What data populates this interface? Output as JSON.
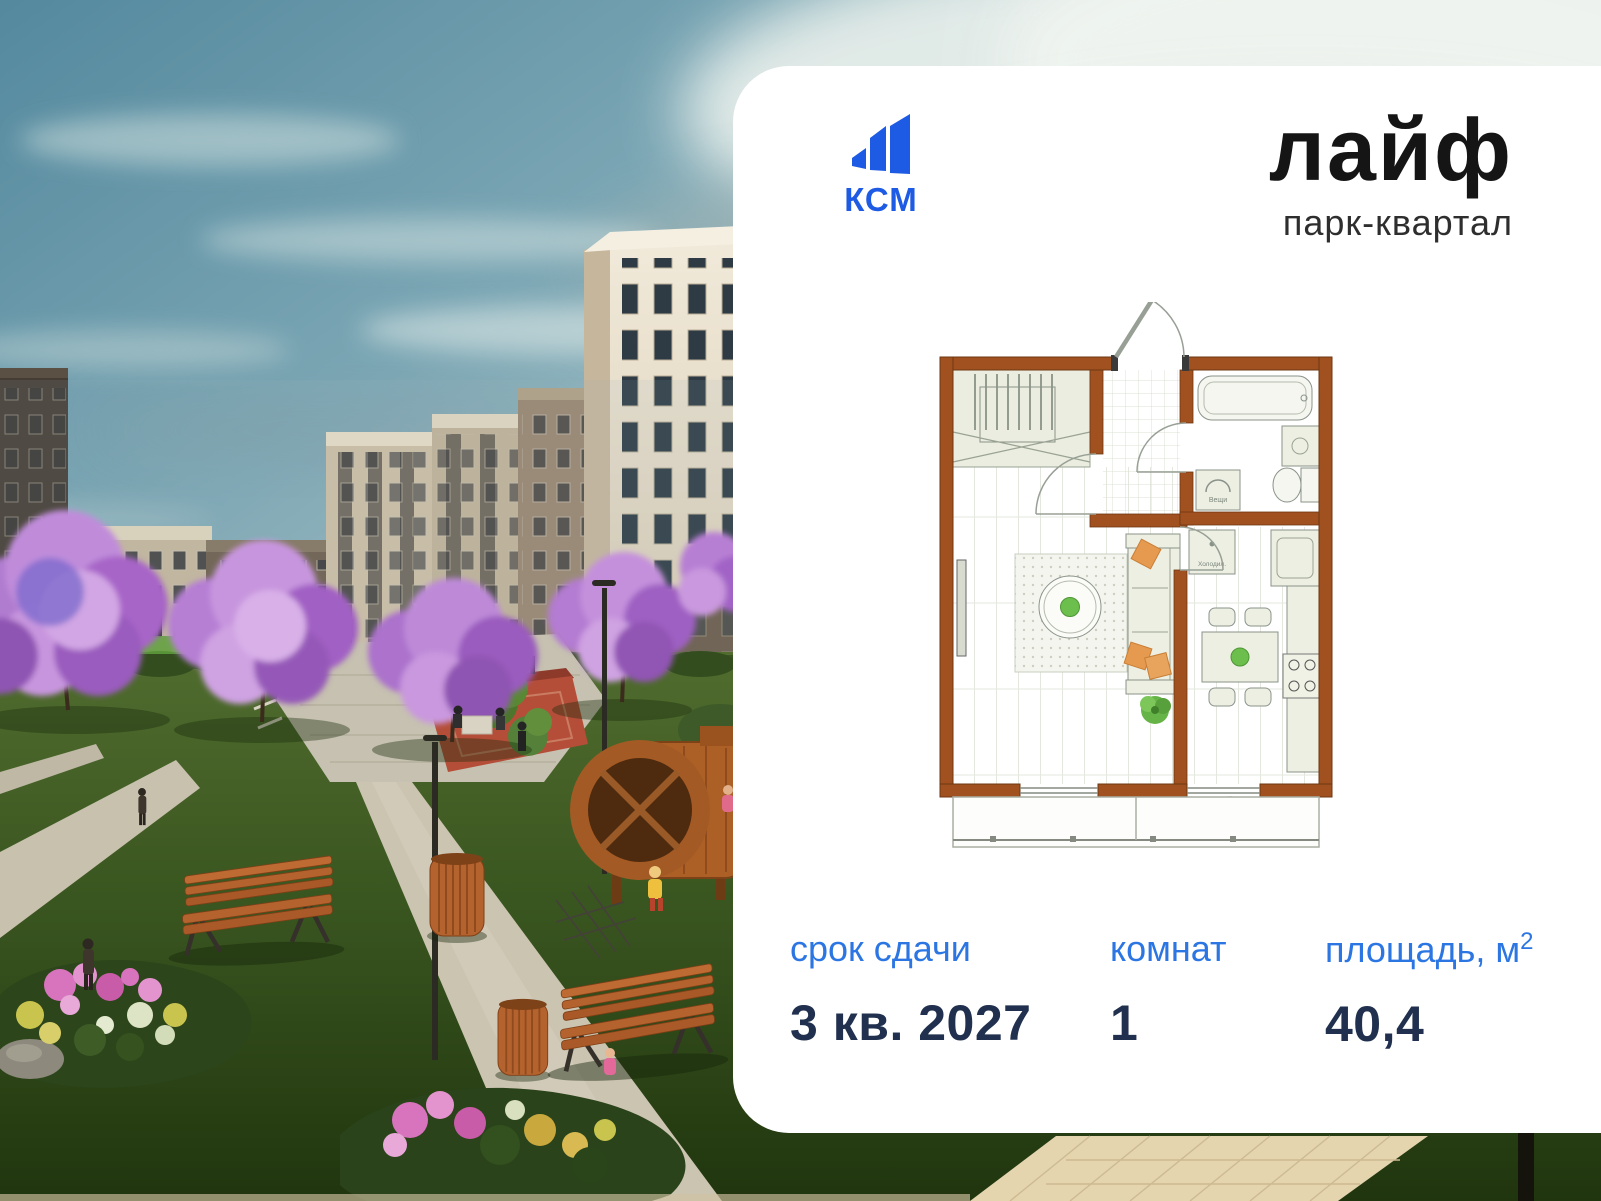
{
  "brand": {
    "logo_text": "КСМ",
    "title": "лайф",
    "subtitle": "парк-квартал"
  },
  "floorplan": {
    "washer_label": "Вещи",
    "fridge_label": "Холодил."
  },
  "specs": {
    "deadline": {
      "label": "срок сдачи",
      "value": "3 кв. 2027"
    },
    "rooms": {
      "label": "комнат",
      "value": "1"
    },
    "area": {
      "label_base": "площадь, м",
      "label_sup": "2",
      "value": "40,4"
    }
  },
  "colors": {
    "logo_blue": "#1E5BE4",
    "label_blue": "#2B76E3",
    "value_navy": "#20304E",
    "plan_wall_brown": "#A0511F",
    "card_bg": "#FFFFFF"
  }
}
